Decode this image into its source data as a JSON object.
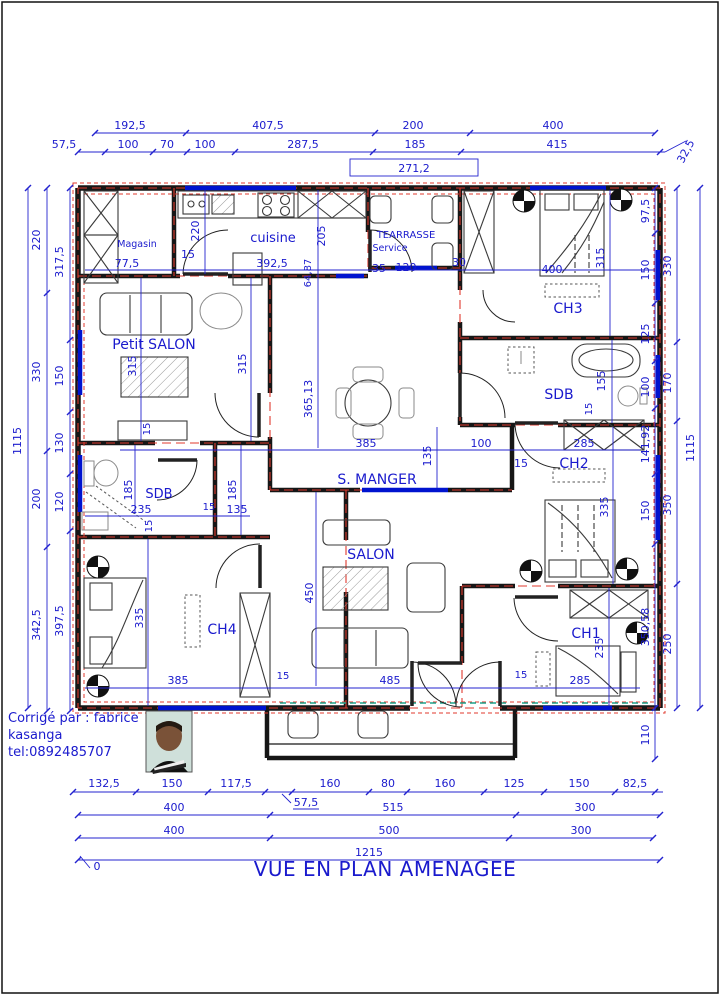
{
  "colors": {
    "dim_blue": "#1a1acd",
    "wall_black": "#161616",
    "axis_red": "#e03a2e",
    "window_blue": "#0013cf",
    "teal_dash": "#1fa28c"
  },
  "title": "VUE EN PLAN AMENAGEE",
  "credit": {
    "line1": "Corrigé par : fabrice",
    "line2": "kasanga",
    "line3": "tel:0892485707"
  },
  "rooms": {
    "magasin": "Magasin",
    "cuisine": "cuisine",
    "terrasse1": "TEARRASSE",
    "terrasse2": "Service",
    "ch3": "CH3",
    "petit_salon": "Petit  SALON",
    "sdb_right": "SDB",
    "s_manger": "S. MANGER",
    "ch2": "CH2",
    "sdb_left": "SDB",
    "salon": "SALON",
    "ch4": "CH4",
    "ch1": "CH1"
  },
  "dims": {
    "top1": [
      "192,5",
      "407,5",
      "200",
      "400"
    ],
    "top2": [
      "57,5",
      "100",
      "70",
      "100",
      "287,5",
      "185",
      "415"
    ],
    "entrance": "271,2",
    "top_right": "32,5",
    "left_outer": "1115",
    "left_mid": [
      "220",
      "330",
      "200",
      "342,5"
    ],
    "left_in": [
      "317,5",
      "150",
      "130",
      "120",
      "397,5"
    ],
    "right_in": [
      "97,5",
      "150",
      "125",
      "100",
      "141,92",
      "150",
      "350,58",
      "110"
    ],
    "right_mid": [
      "330",
      "170",
      "350",
      "250"
    ],
    "right_outer": "1115",
    "bottom1": [
      "132,5",
      "150",
      "117,5",
      "160",
      "80",
      "160",
      "125",
      "150",
      "82,5"
    ],
    "bottom1_note": "57,5",
    "bottom2": [
      "400",
      "515",
      "300"
    ],
    "bottom3": [
      "400",
      "500",
      "300"
    ],
    "bottom_total": "1215",
    "origin": "0",
    "interior": {
      "magasin_w": "77,5",
      "magasin_h": "220",
      "cuisine_door": "15",
      "cuisine_w": "392,5",
      "cuisine_h": "205",
      "cuisine_x": "64,87",
      "terr_a": "35",
      "terr_b": "120",
      "terr_c": "30",
      "ch3_w": "400",
      "ch3_h": "315",
      "ps_h1": "315",
      "ps_h2": "315",
      "ps_d": "15",
      "sm_h": "365,13",
      "sm_w": "385",
      "sm_a": "135",
      "sm_b": "100",
      "sm_c": "15",
      "sdbr_a": "155",
      "sdbr_b": "15",
      "sdbr_w": "285",
      "ch2_h": "335",
      "sdbl_a": "185",
      "sdbl_b": "185",
      "sdbl_w": "235",
      "sdbl_c": "15",
      "sdbl_d": "135",
      "sdbl_e": "15",
      "ch4_h": "335",
      "ch4_w": "385",
      "ch4_d": "15",
      "salon_h": "450",
      "salon_w": "485",
      "ch1_h": "235",
      "ch1_d": "15",
      "ch1_w": "285"
    }
  }
}
